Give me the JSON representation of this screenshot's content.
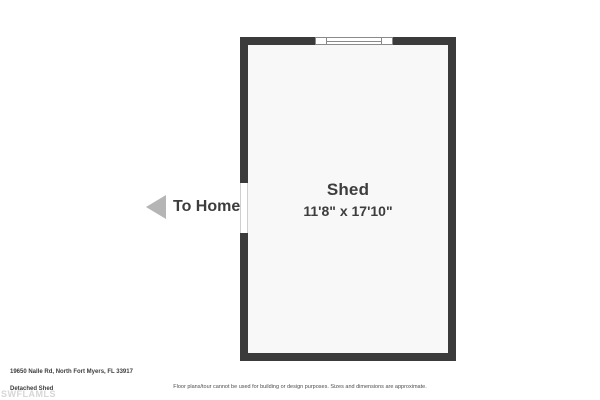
{
  "floorplan": {
    "room": {
      "name": "Shed",
      "dimensions": "11'8\" x 17'10\""
    },
    "to_home_label": "To Home",
    "icons": {
      "to_home_arrow": "left-triangle-arrow-icon",
      "window": "window-symbol",
      "door": "door-opening"
    }
  },
  "footer": {
    "address": "19650 Nalle Rd, North Fort Myers, FL 33917",
    "plan_title": "Detached Shed",
    "watermark": "SWFLAMLS",
    "disclaimer": "Floor plans/tour cannot be used for building or design purposes. Sizes and dimensions are approximate."
  },
  "colors": {
    "wall": "#3b3b3b",
    "room_fill": "#f8f8f8",
    "text_dark": "#3d3d3d",
    "arrow_gray": "#b5b5b5",
    "watermark_gray": "#d6d6d6",
    "background": "#ffffff"
  }
}
